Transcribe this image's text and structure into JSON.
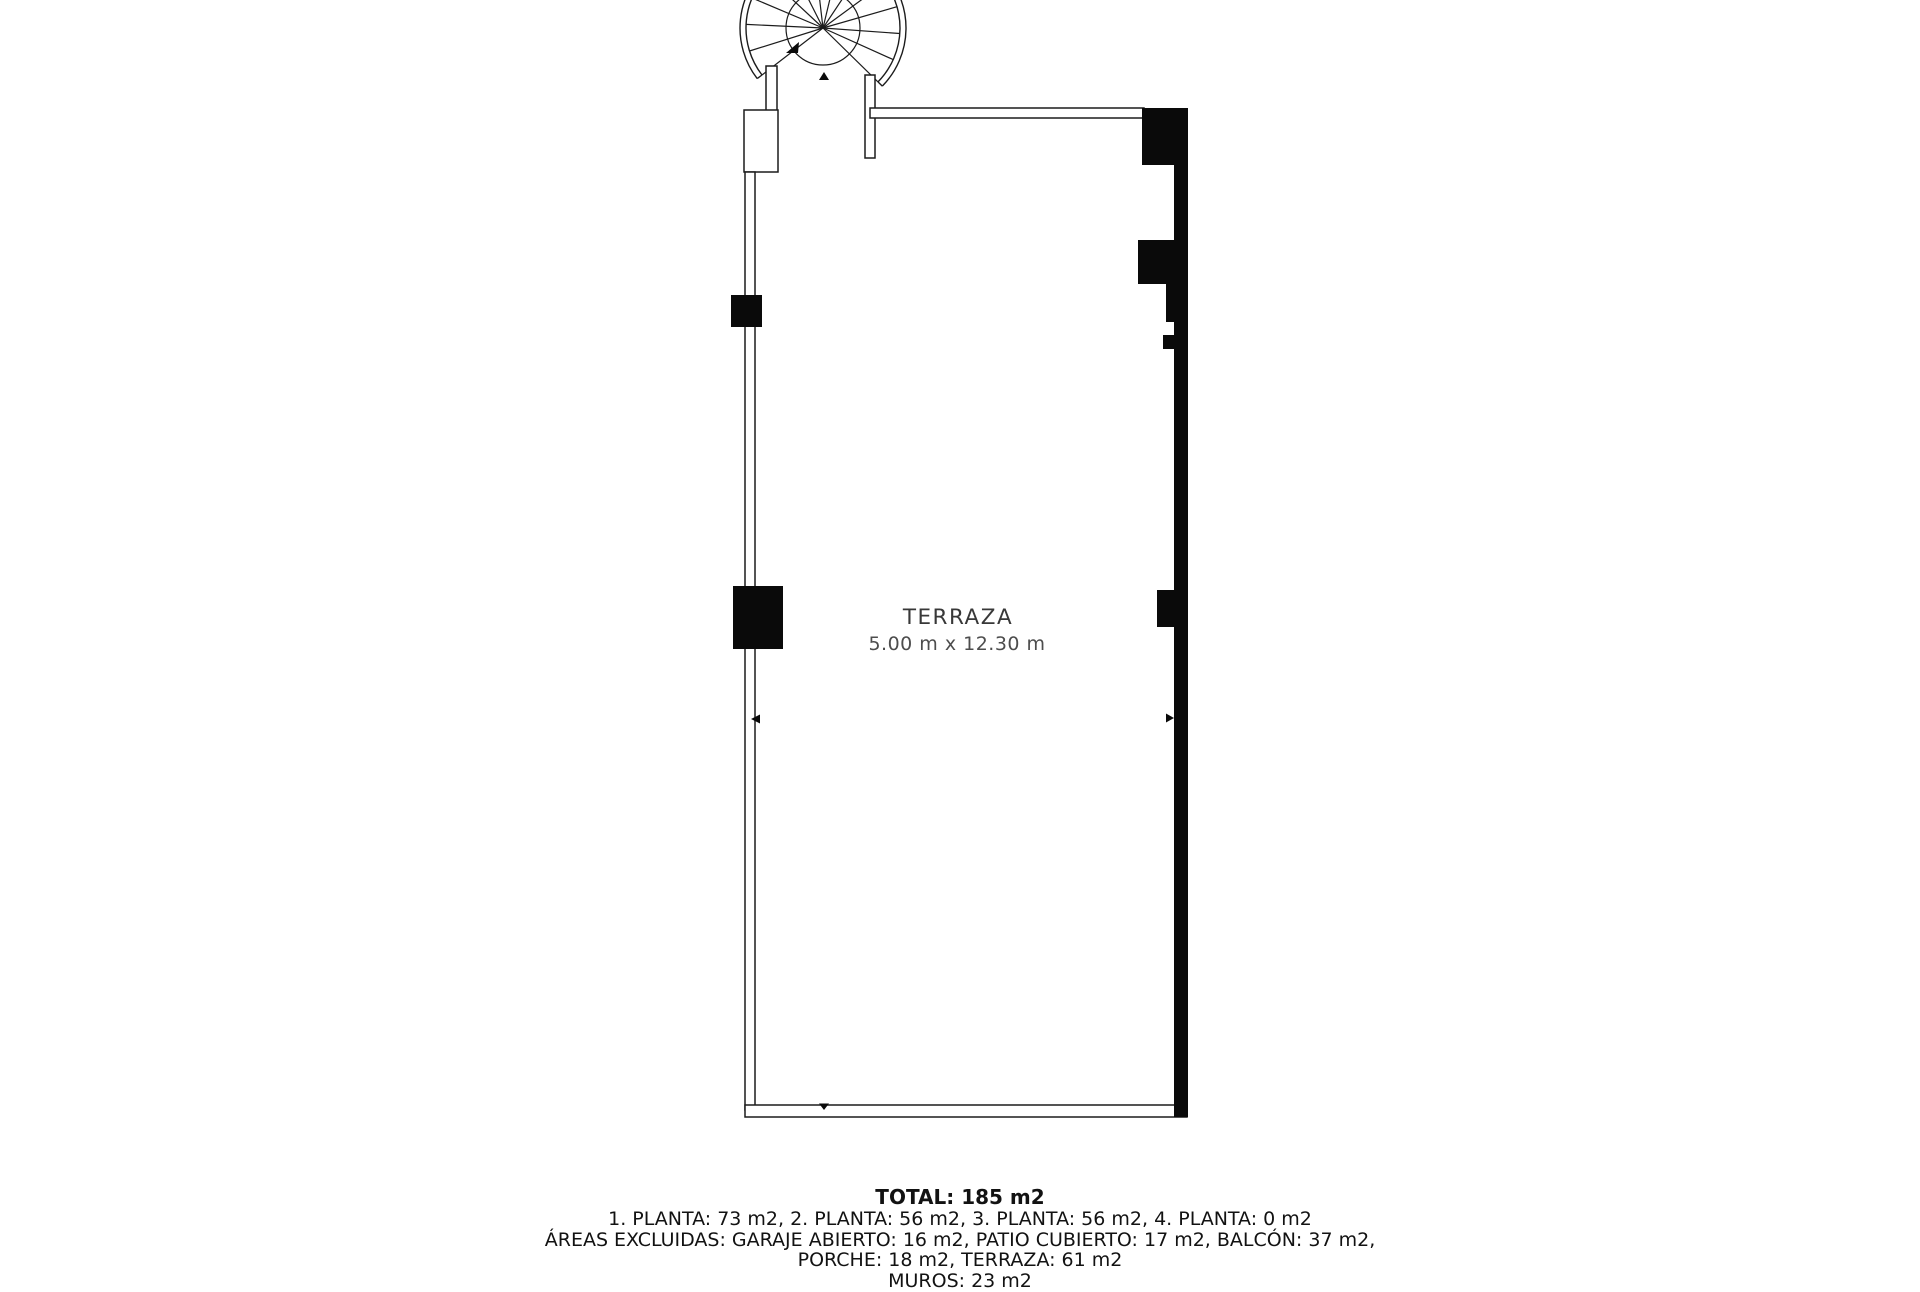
{
  "page": {
    "background": "#ffffff",
    "line_color": "#1c1c1c",
    "wall_fill_color": "#0a0a0a"
  },
  "floor_plan": {
    "room": {
      "name": "TERRAZA",
      "dimensions": "5.00 m x 12.30 m"
    },
    "summary": {
      "total": "TOTAL: 185 m2",
      "lines": [
        "1. PLANTA: 73 m2, 2. PLANTA: 56 m2, 3. PLANTA: 56 m2, 4. PLANTA: 0 m2",
        "ÁREAS EXCLUIDAS: GARAJE ABIERTO: 16 m2, PATIO CUBIERTO: 17 m2, BALCÓN: 37 m2,",
        "PORCHE: 18 m2, TERRAZA: 61 m2",
        "MUROS: 23 m2"
      ]
    }
  }
}
